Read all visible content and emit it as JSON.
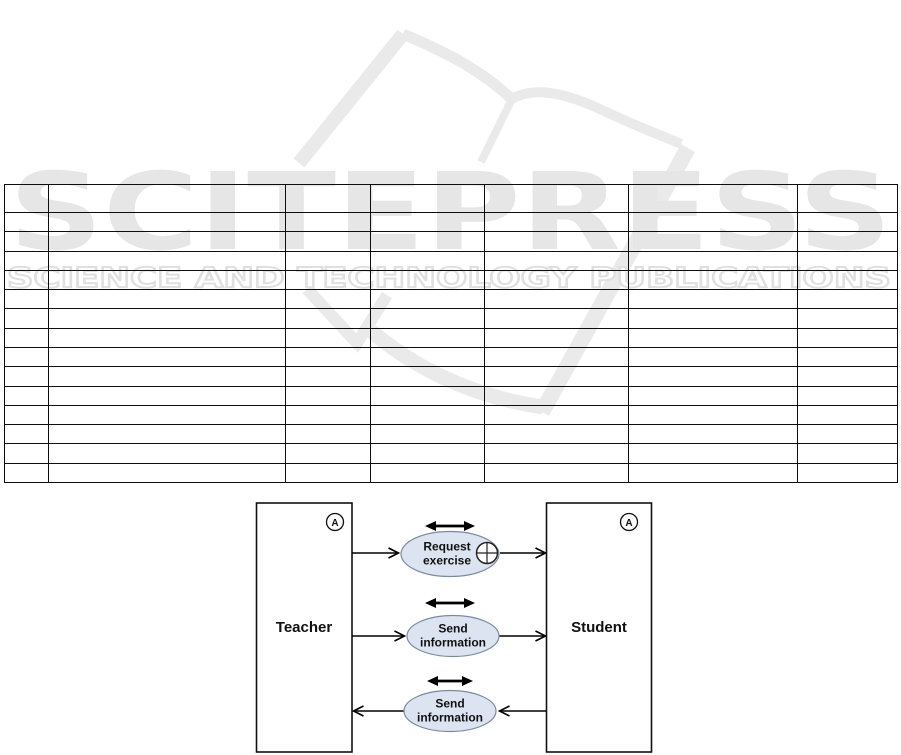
{
  "watermark": {
    "brand": "SCITEPRESS",
    "tagline": "SCIENCE AND TECHNOLOGY PUBLICATIONS",
    "brand_color": "#e6e6e6",
    "logo_color": "#eaeaea"
  },
  "table": {
    "rows": 15,
    "cols": 7,
    "col_widths": [
      44,
      237,
      85,
      114,
      144,
      169,
      100
    ],
    "header_row_height": 28,
    "body_row_height": 19.29,
    "cells_empty": true
  },
  "diagram": {
    "actors": [
      {
        "name": "Teacher",
        "badge": "A"
      },
      {
        "name": "Student",
        "badge": "A"
      }
    ],
    "use_cases": [
      {
        "line1": "Request",
        "line2": "exercise",
        "has_extension_point": true,
        "direction": "teacher-to-student"
      },
      {
        "line1": "Send",
        "line2": "information",
        "has_extension_point": false,
        "direction": "teacher-to-student"
      },
      {
        "line1": "Send",
        "line2": "information",
        "has_extension_point": false,
        "direction": "student-to-teacher"
      }
    ],
    "oval_fill": "#dce4f1",
    "oval_stroke": "#7c8aa0",
    "arrow_color": "#000000"
  }
}
